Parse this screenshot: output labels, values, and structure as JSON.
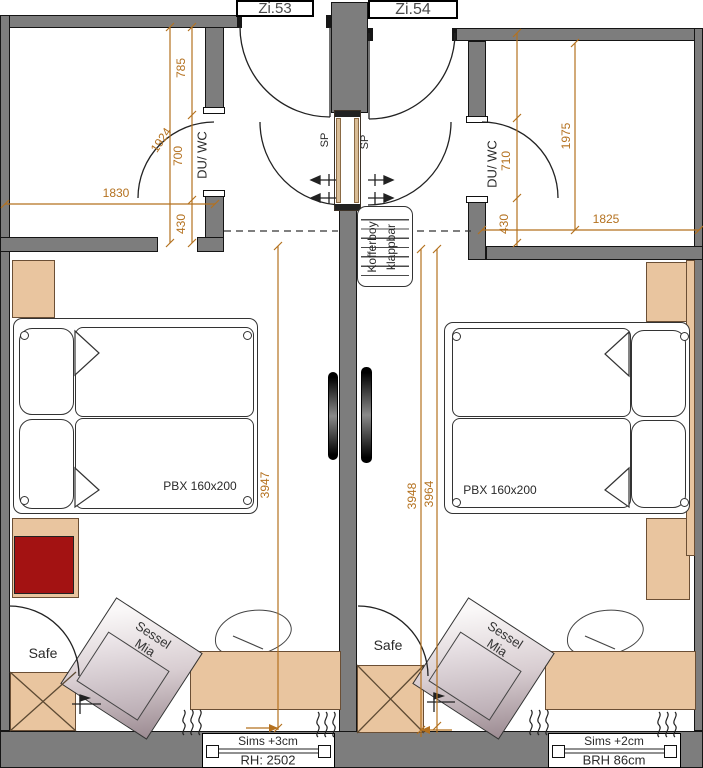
{
  "drawing": {
    "left_room": {
      "label": "Zi.53",
      "bathroom_label": "DU/ WC",
      "mirror_label": "SP",
      "bed_label": "PBX 160x200",
      "safe_label": "Safe",
      "armchair_label_line1": "Sessel",
      "armchair_label_line2": "Mia",
      "window_label_line1": "Sims +3cm",
      "window_label_line2": "RH: 2502",
      "dims": {
        "entry_total": "1924",
        "entry_top": "785",
        "entry_mid": "700",
        "entry_bottom": "430",
        "bath_width": "1830",
        "room_depth": "3947"
      }
    },
    "right_room": {
      "label": "Zi.54",
      "bathroom_label": "DU/ WC",
      "mirror_label": "SP",
      "bed_label": "PBX 160x200",
      "safe_label": "Safe",
      "armchair_label_line1": "Sessel",
      "armchair_label_line2": "Mia",
      "window_label_line1": "Sims +2cm",
      "window_label_line2": "BRH 86cm",
      "dims": {
        "entry_total": "1975",
        "entry_mid": "710",
        "entry_bottom": "430",
        "bath_width": "1825",
        "room_depth_a": "3948",
        "room_depth_b": "3964"
      }
    },
    "center": {
      "luggage_rack_line1": "Kofferboy",
      "luggage_rack_line2": "klappbar"
    },
    "colors": {
      "wall_gray": "#7d7d7d",
      "dimension_orange": "#b4711f",
      "furniture_tan": "#e9c59f",
      "accent_red": "#a31212"
    }
  }
}
